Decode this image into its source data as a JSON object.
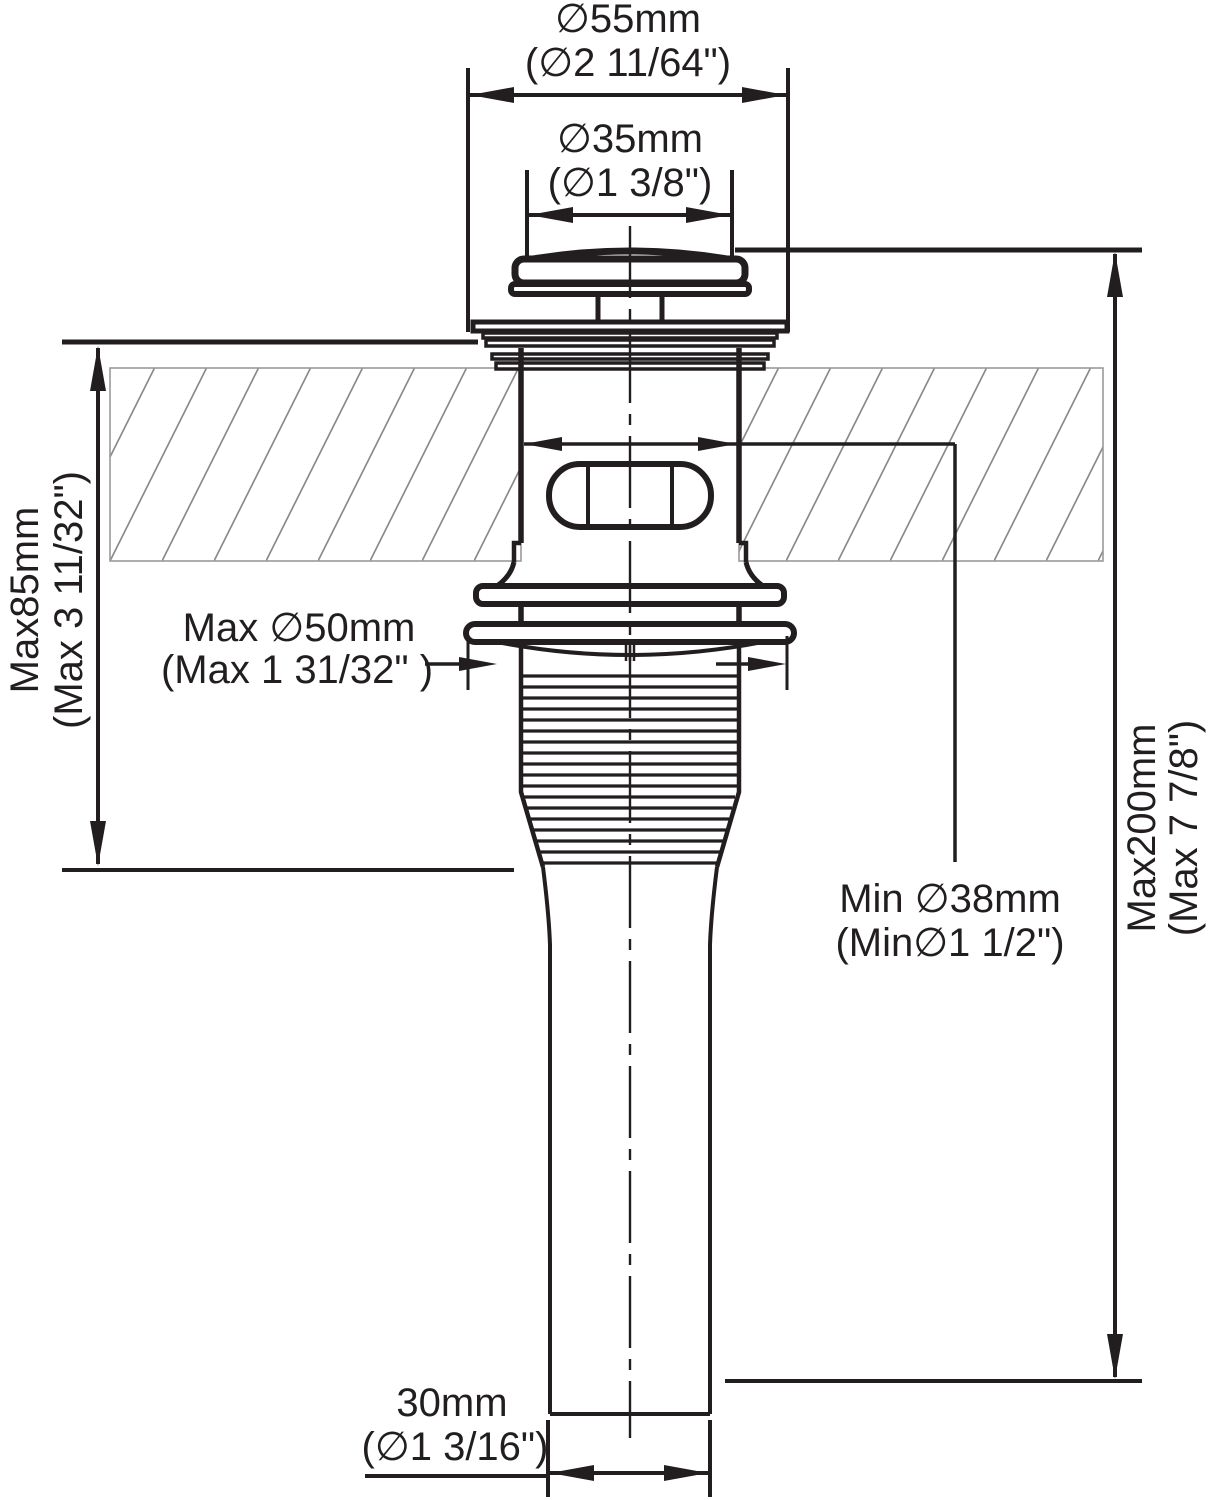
{
  "diagram": {
    "type": "technical-drawing",
    "subject": "pop-up sink drain mounting dimensions",
    "background": "#ffffff",
    "line_color": "#221e1f",
    "hatch_color": "#8a8a8a",
    "dimensions": {
      "flange_outer": {
        "metric": "∅55mm",
        "imperial": "(∅2 11/64\")"
      },
      "cap": {
        "metric": "∅35mm",
        "imperial": "(∅1 3/8\")"
      },
      "deck_thickness": {
        "metric": "Max85mm",
        "imperial": "(Max 3 11/32\")"
      },
      "mounting_hole": {
        "metric": "Max ∅50mm",
        "imperial": "(Max 1 31/32\" )"
      },
      "drain_inner": {
        "metric": "Min ∅38mm",
        "imperial": "(Min∅1 1/2\")"
      },
      "total_length": {
        "metric": "Max200mm",
        "imperial": "(Max 7 7/8\")"
      },
      "tailpipe": {
        "metric": "30mm",
        "imperial": "(∅1 3/16\")"
      }
    }
  }
}
